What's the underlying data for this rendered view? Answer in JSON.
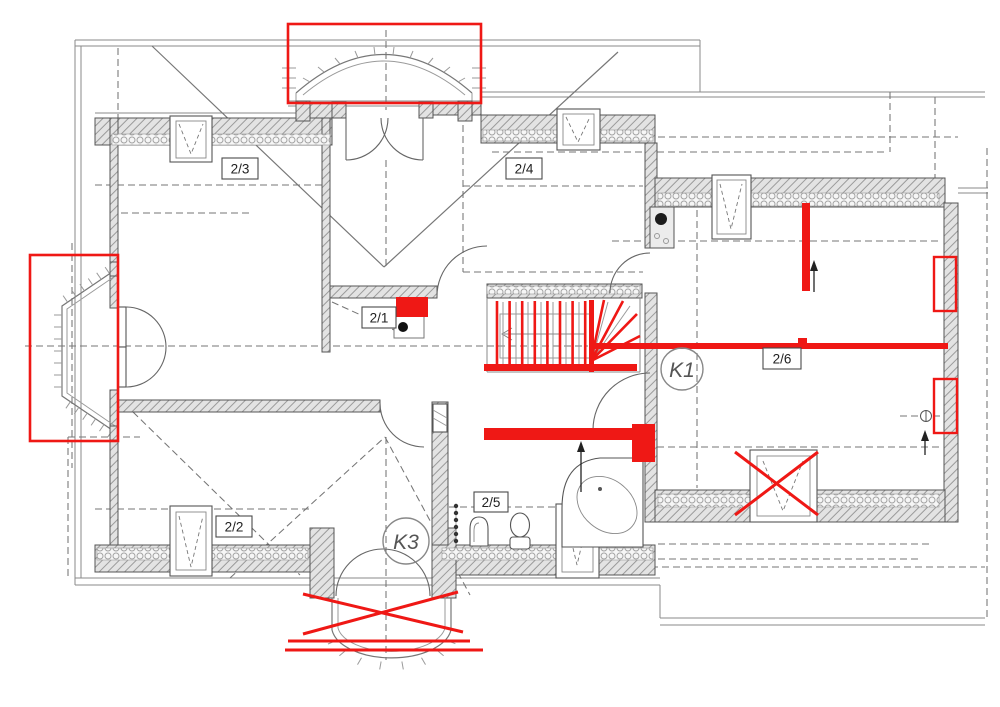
{
  "colors": {
    "annotation_red": "#ef1815"
  },
  "labels": {
    "room_2_1": "2/1",
    "room_2_2": "2/2",
    "room_2_3": "2/3",
    "room_2_4": "2/4",
    "room_2_5": "2/5",
    "room_2_6": "2/6",
    "marker_k1": "K1",
    "marker_k3": "K3"
  }
}
